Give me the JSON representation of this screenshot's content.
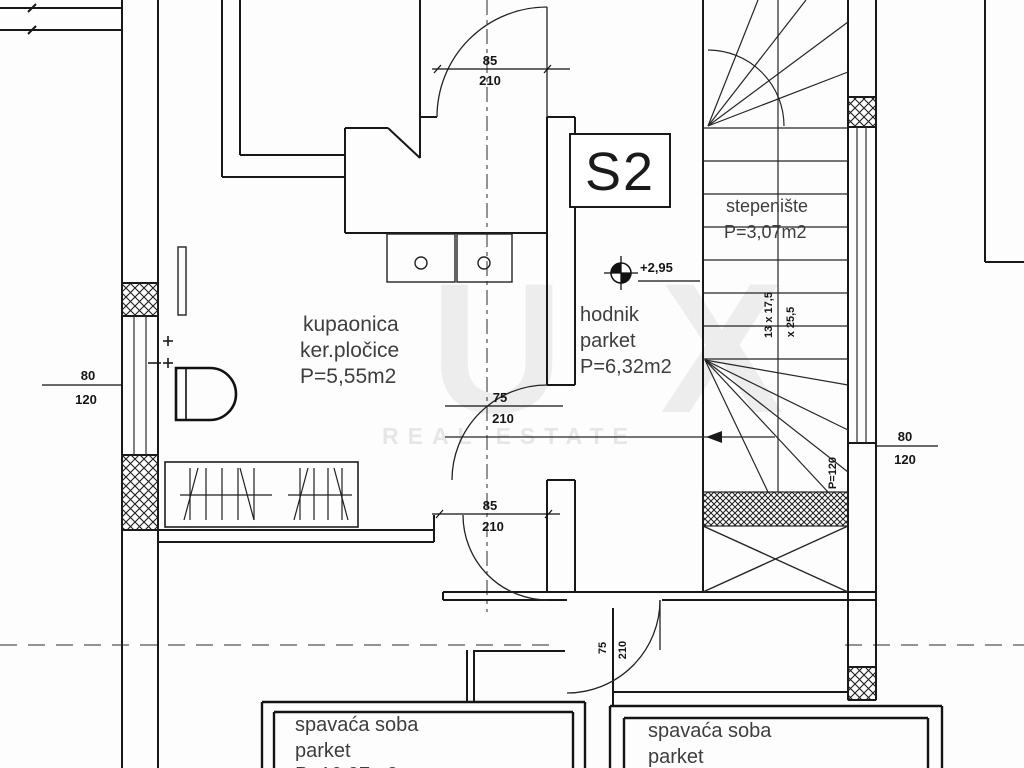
{
  "unit": {
    "label": "S2"
  },
  "elevation": {
    "value": "+2,95"
  },
  "rooms": {
    "stepeniste": {
      "name": "stepenište",
      "area": "P=3,07m2"
    },
    "kupaonica": {
      "name": "kupaonica",
      "finish": "ker.pločice",
      "area": "P=5,55m2"
    },
    "hodnik": {
      "name": "hodnik",
      "finish": "parket",
      "area": "P=6,32m2"
    },
    "spavaca_lijeva": {
      "name": "spavaća soba",
      "finish": "parket",
      "area": "P=10,97m2"
    },
    "spavaca_desna": {
      "name": "spavaća soba",
      "finish": "parket"
    }
  },
  "openings": {
    "door_top": {
      "w": "85",
      "h": "210"
    },
    "door_bathroom": {
      "w": "75",
      "h": "210"
    },
    "door_lower": {
      "w": "85",
      "h": "210"
    },
    "door_bedroom": {
      "w": "75",
      "h": "210"
    },
    "window_left": {
      "w": "80",
      "h": "120"
    },
    "window_right": {
      "w": "80",
      "h": "120"
    },
    "parapet": "P=120"
  },
  "stairs": {
    "dims": [
      "13 x 17,5",
      "x 25,5"
    ]
  },
  "watermark": {
    "letter1": "U",
    "letter2": "X",
    "subtitle": "REAL ESTATE"
  }
}
